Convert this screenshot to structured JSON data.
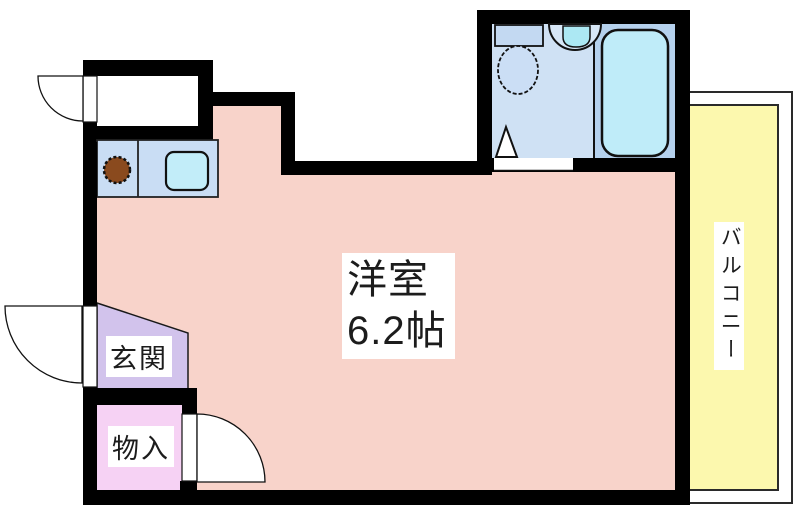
{
  "floorplan": {
    "main_room": {
      "name": "洋室",
      "size": "6.2帖"
    },
    "entrance": {
      "label": "玄関"
    },
    "storage": {
      "label": "物入"
    },
    "balcony": {
      "label": "バルコニー"
    },
    "colors": {
      "wall": "#000000",
      "main_room_floor": "#f8d3ca",
      "entrance_floor": "#d2c3ec",
      "storage_floor": "#f6d2f4",
      "balcony_floor": "#fcf8ae",
      "kitchen_counter": "#c9ddf4",
      "kitchen_sink": "#c2edf9",
      "stove": "#8a4a1e",
      "toilet_room_floor": "#cfe1f4",
      "bathing_room_floor": "#b5d1ed",
      "bathtub": "#bfecf9",
      "toilet_tank": "#c3d9f2",
      "toilet_bowl": "#cbdef5",
      "washbasin": "#d7e7f7",
      "washbasin_bowl": "#ace8f3"
    }
  }
}
